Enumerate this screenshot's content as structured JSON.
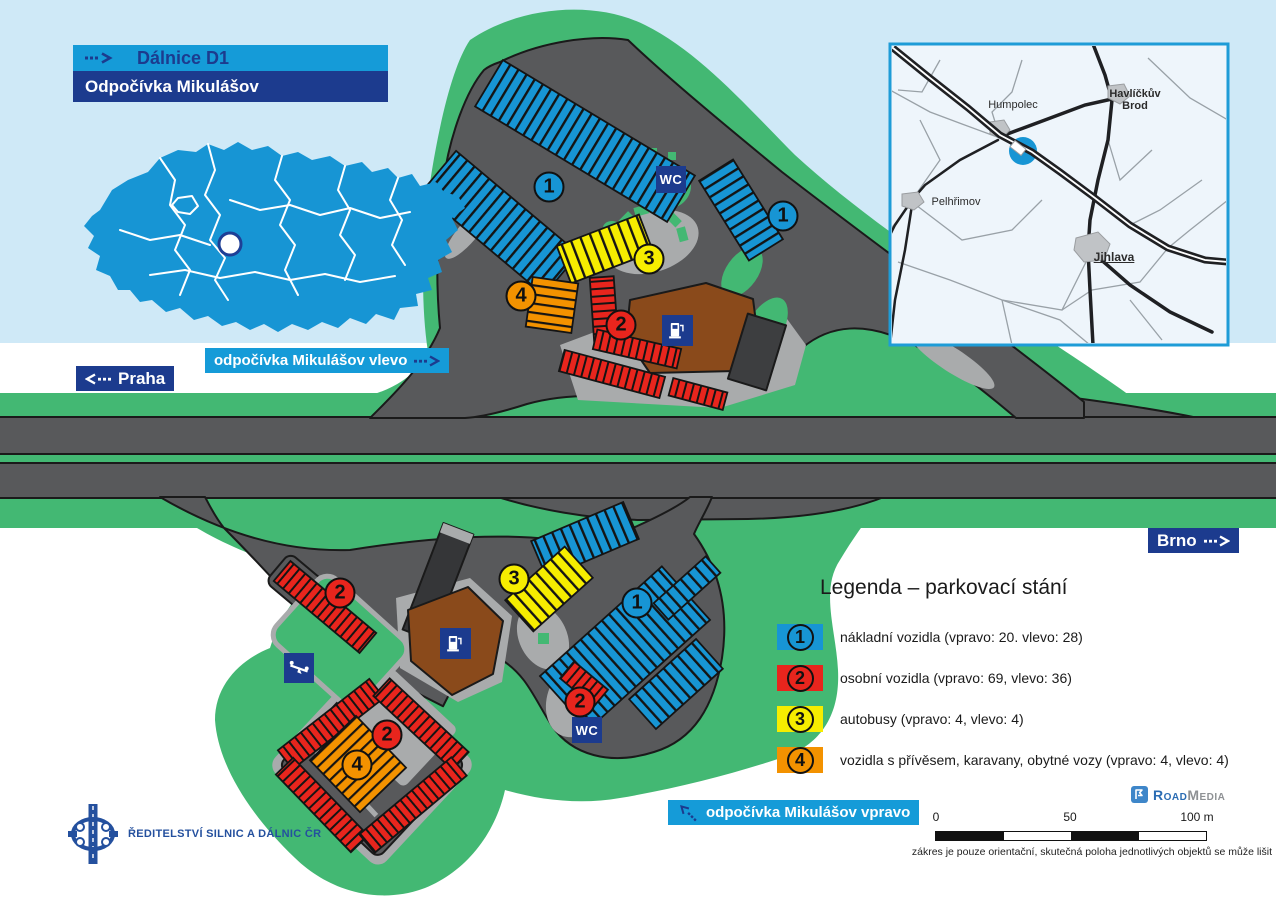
{
  "header": {
    "road": "Dálnice D1",
    "site": "Odpočívka Mikulášov"
  },
  "nav": {
    "praha": "Praha",
    "brno": "Brno",
    "vlevo": "odpočívka Mikulášov vlevo",
    "vpravo": "odpočívka Mikulášov vpravo"
  },
  "facilities": {
    "wc": "WC"
  },
  "legend": {
    "title": "Legenda – parkovací stání",
    "items": [
      {
        "number": "1",
        "color": "#1795d4",
        "label": "nákladní vozidla (vpravo: 20. vlevo: 28)"
      },
      {
        "number": "2",
        "color": "#e8251d",
        "label": "osobní vozidla (vpravo: 69, vlevo: 36)"
      },
      {
        "number": "3",
        "color": "#f6ed00",
        "label": "autobusy (vpravo: 4, vlevo: 4)"
      },
      {
        "number": "4",
        "color": "#f39200",
        "label": "vozidla s přívěsem, karavany, obytné vozy (vpravo: 4, vlevo: 4)"
      }
    ]
  },
  "badges": {
    "upper": [
      {
        "number": "1"
      },
      {
        "number": "1"
      },
      {
        "number": "3"
      },
      {
        "number": "4"
      },
      {
        "number": "2"
      }
    ],
    "lower": [
      {
        "number": "2"
      },
      {
        "number": "3"
      },
      {
        "number": "1"
      },
      {
        "number": "2"
      },
      {
        "number": "4"
      },
      {
        "number": "2"
      }
    ]
  },
  "inset_map": {
    "cities": [
      {
        "name": "Humpolec"
      },
      {
        "name": "Havlíčkův Brod"
      },
      {
        "name": "Pelhřimov"
      },
      {
        "name": "Jihlava"
      }
    ]
  },
  "scale_bar": {
    "ticks": [
      {
        "label": "0"
      },
      {
        "label": "50"
      },
      {
        "label": "100 m"
      }
    ]
  },
  "footer": {
    "brand_road": "Road",
    "brand_media": "Media",
    "disclaimer": "zákres je pouze orientační, skutečná poloha jednotlivých objektů se může lišit",
    "agency": "ŘEDITELSTVÍ SILNIC A DÁLNIC ČR"
  },
  "colors": {
    "truck_blue": "#1795d4",
    "car_red": "#e8251d",
    "bus_yellow": "#f6ed00",
    "caravan_orange": "#f39200",
    "green": "#43b873",
    "asphalt": "#58595b",
    "island_gray": "#a9abac",
    "navy": "#1c3b8e",
    "header_blue": "#159bd8",
    "sky_blue": "#cfe9f7",
    "building_brown": "#8a4a1b"
  }
}
